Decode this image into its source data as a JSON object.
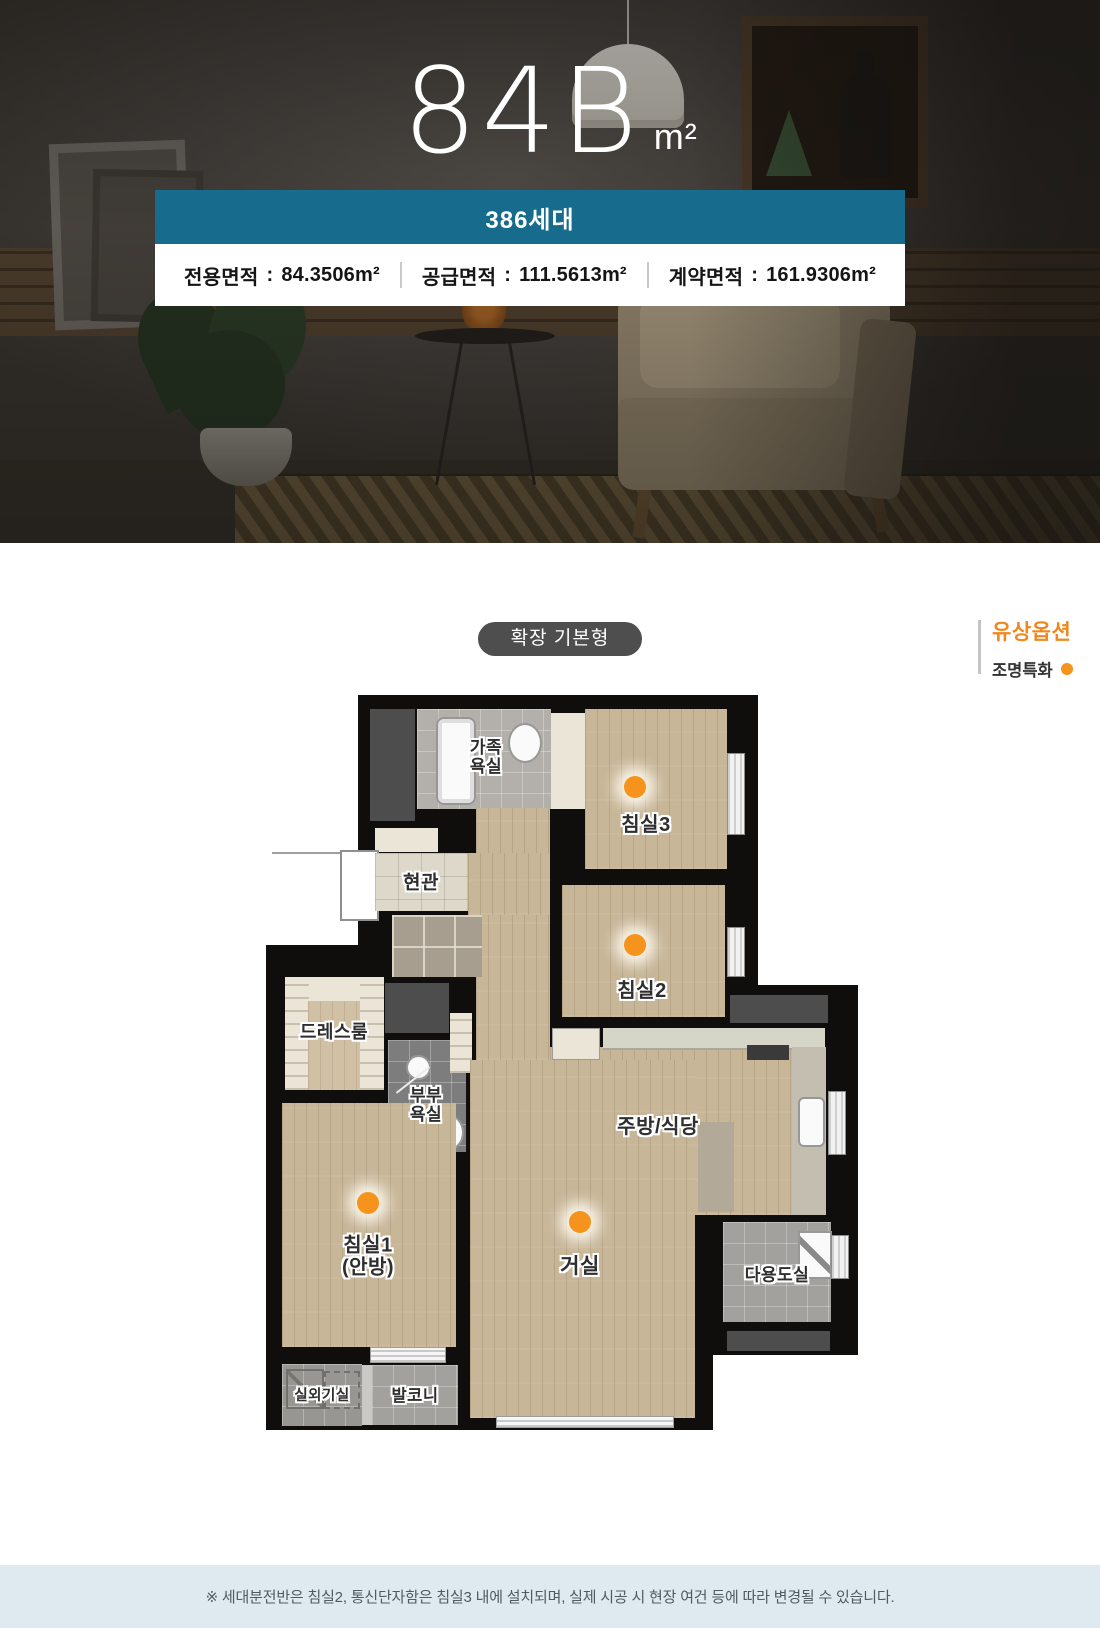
{
  "hero": {
    "unit_code": "84B",
    "unit_suffix": "m²",
    "households_badge": "386세대",
    "separator": ":",
    "areas": [
      {
        "label": "전용면적",
        "value": "84.3506m²"
      },
      {
        "label": "공급면적",
        "value": "111.5613m²"
      },
      {
        "label": "계약면적",
        "value": "161.9306m²"
      }
    ]
  },
  "options": {
    "plan_type_pill": "확장 기본형",
    "paid_option_title": "유상옵션",
    "paid_option_item": "조명특화"
  },
  "floorplan": {
    "rooms": {
      "family_bath": "가족\n욕실",
      "bedroom3": "침실3",
      "entrance": "현관",
      "bedroom2": "침실2",
      "dressroom": "드레스룸",
      "master_bath": "부부\n욕실",
      "kitchen": "주방/식당",
      "bedroom1": "침실1\n(안방)",
      "living": "거실",
      "utility": "다용도실",
      "ac_room": "실외기실",
      "balcony": "발코니"
    },
    "light_dots_in": [
      "침실3",
      "침실2",
      "침실1",
      "거실"
    ]
  },
  "footer": {
    "note": "※ 세대분전반은 침실2, 통신단자함은 침실3 내에 설치되며, 실제 시공 시 현장 여건 등에 따라 변경될 수 있습니다."
  },
  "colors": {
    "accent_teal": "#176b8d",
    "accent_orange": "#f0881f",
    "dot_orange": "#f6931d",
    "footer_bg": "#dfe9f0"
  }
}
